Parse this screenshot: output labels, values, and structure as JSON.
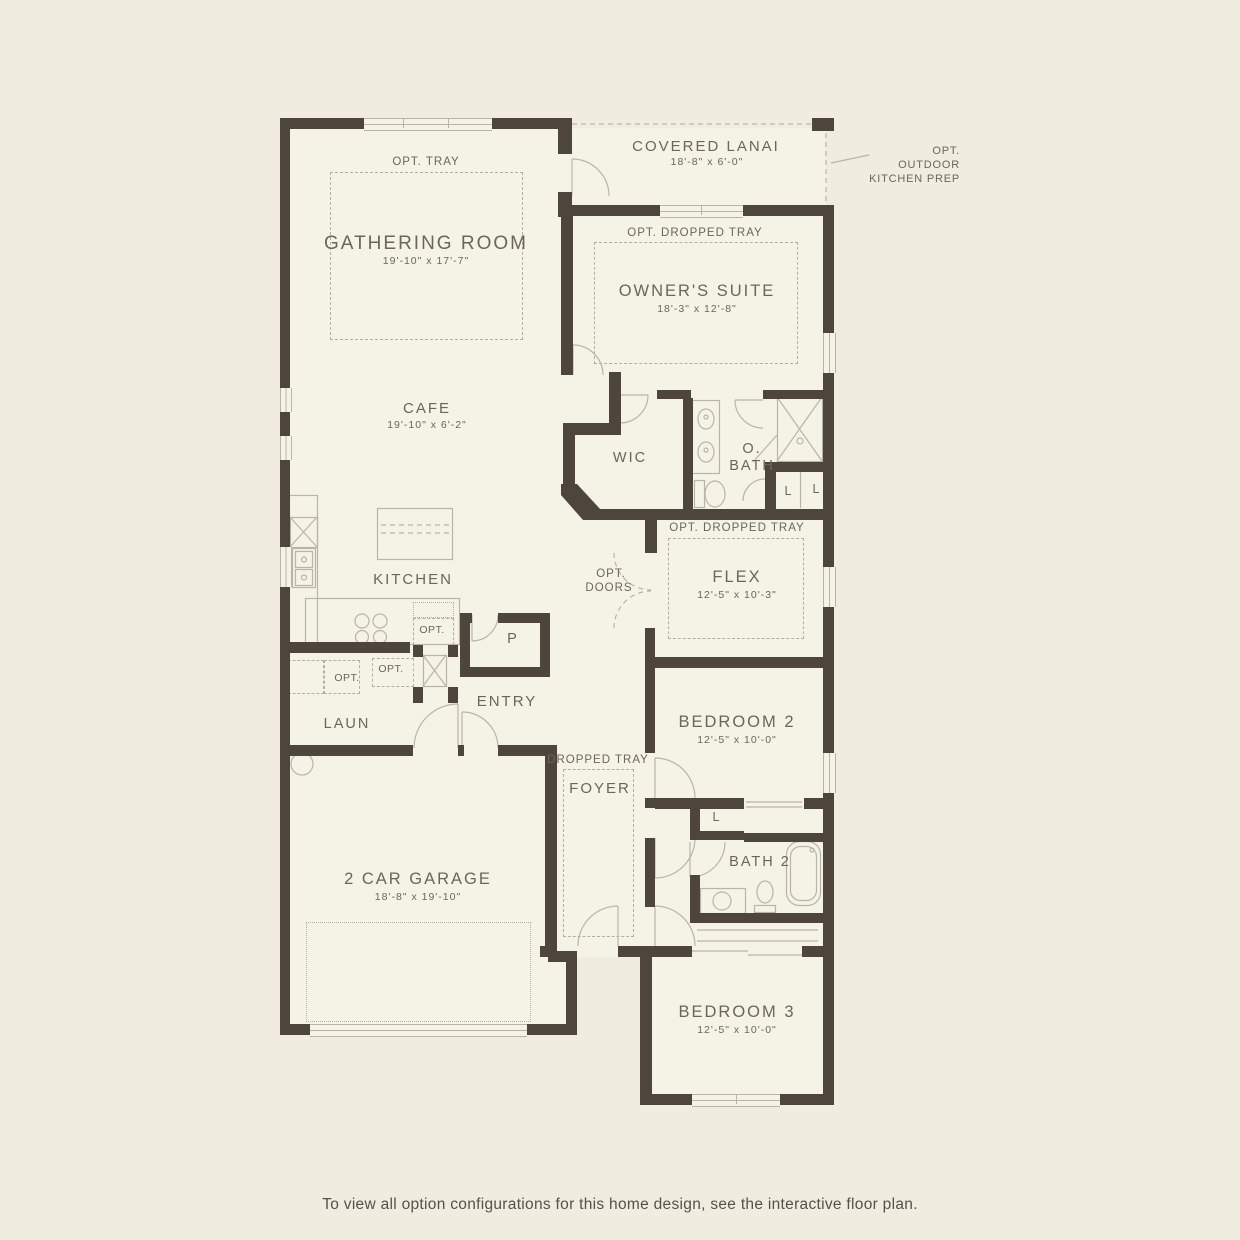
{
  "plan": {
    "rooms": {
      "gathering_room": {
        "name": "GATHERING ROOM",
        "dims": "19'-10\" x 17'-7\""
      },
      "covered_lanai": {
        "name": "COVERED LANAI",
        "dims": "18'-8\" x 6'-0\""
      },
      "owners_suite": {
        "name": "OWNER'S SUITE",
        "dims": "18'-3\" x 12'-8\""
      },
      "cafe": {
        "name": "CAFE",
        "dims": "19'-10\" x 6'-2\""
      },
      "kitchen": {
        "name": "KITCHEN"
      },
      "wic": {
        "name": "WIC"
      },
      "owners_bath": {
        "line1": "O.",
        "line2": "BATH"
      },
      "flex": {
        "name": "FLEX",
        "dims": "12'-5\" x 10'-3\""
      },
      "pantry": {
        "name": "P"
      },
      "entry": {
        "name": "ENTRY"
      },
      "laundry": {
        "name": "LAUN"
      },
      "bedroom2": {
        "name": "BEDROOM 2",
        "dims": "12'-5\" x 10'-0\""
      },
      "foyer": {
        "name": "FOYER"
      },
      "bath2": {
        "name": "BATH 2"
      },
      "garage": {
        "name": "2 CAR GARAGE",
        "dims": "18'-8\" x 19'-10\""
      },
      "bedroom3": {
        "name": "BEDROOM 3",
        "dims": "12'-5\" x 10'-0\""
      },
      "linen": {
        "name": "L"
      }
    },
    "annotations": {
      "opt_tray": "OPT. TRAY",
      "opt_dropped_tray": "OPT. DROPPED TRAY",
      "dropped_tray": "DROPPED TRAY",
      "opt_doors_line1": "OPT.",
      "opt_doors_line2": "DOORS",
      "opt": "OPT.",
      "outdoor_kitchen_line1": "OPT. OUTDOOR",
      "outdoor_kitchen_line2": "KITCHEN PREP"
    }
  },
  "footer": {
    "caption": "To view all option configurations for this home design, see the interactive floor plan."
  },
  "colors": {
    "wall": "#4e463c",
    "thin_line": "#b9b5a6",
    "dash": "#b3afa0",
    "text": "#6b665b",
    "background": "#f0ecdf",
    "floor": "#f5f2e6",
    "caption": "#55514a"
  }
}
